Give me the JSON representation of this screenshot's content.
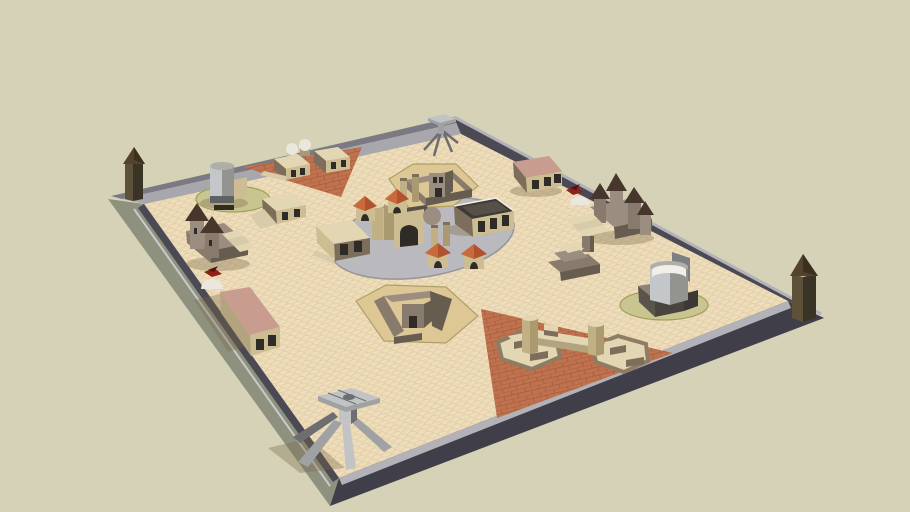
{
  "scene": {
    "type": "3d-model-render",
    "objects": [
      "boundary-wall",
      "corner-tower-west",
      "corner-tower-east",
      "gate-tripod-north",
      "gate-tripod-south",
      "water-silo-west",
      "market-cluster-northwest",
      "ramp-building-north",
      "castle-west",
      "dome-and-bird-west",
      "long-building-southwest",
      "walled-compound-north",
      "central-plaza",
      "plaza-pavilions",
      "grain-silo-gate",
      "warehouse-building",
      "walled-compound-south",
      "long-building-north",
      "dome-and-bird-north",
      "castle-east",
      "stepped-platform-east",
      "spiral-tower-complex-east",
      "bridge-compound-southeast",
      "terracotta-zone-northwest",
      "terracotta-zone-southeast",
      "sand-ground",
      "grass-pad-west",
      "grass-pad-east"
    ]
  },
  "colors": {
    "bg": "#d5d2b8",
    "sand": "#eeddbb",
    "sand_line": "#dfc9a0",
    "wall_nw_dark": "#7b7a83",
    "wall_top": "#a8a7ae",
    "wall_top_light": "#b3b2b9",
    "wall_dark": "#4a4954",
    "wall_darker": "#403f49",
    "wall_outer_sw": "#8f917f",
    "wall_edge_light": "#c9c9cd",
    "plaza": "#bab9be",
    "plaza_edge": "#96959b",
    "terracotta": "#c0724e",
    "terracotta_line": "#a45d3e",
    "pad": "#dcc795",
    "pad_edge": "#b0a066",
    "grass": "#c9c591",
    "grass_edge": "#a19e5c",
    "tan_top": "#e3d6b2",
    "tan_wall": "#cdbd92",
    "tan_mid": "#b3a37f",
    "tan_dark": "#7c6e5a",
    "step_light": "#d8cbaa",
    "hexwall": "#8c7d64",
    "castle_body": "#9b8d7f",
    "castle_mid": "#887a6c",
    "castle_dark": "#675c50",
    "cone": "#46362b",
    "roof_red": "#b0522f",
    "roof_red_light": "#c96a3d",
    "roof_black": "#3e3a35",
    "roof_gray": "#575049",
    "window_dark": "#2f2b26",
    "dome_white": "#eae7de",
    "pink_roof": "#c89c8f",
    "metal_light": "#c2c3c5",
    "metal_mid": "#9fa1a3",
    "metal_dark": "#6d6e70",
    "silo_light": "#c3c7ca",
    "silo_mid": "#93948f",
    "silo_top": "#aeafa9",
    "silo_back": "#7e7f82",
    "silo_band": "#5f6264",
    "grain_light": "#c1b084",
    "grain_dark": "#ab9a70",
    "base_gray": "#8d8377",
    "base_mid": "#5a544c",
    "base_dark": "#4a443e",
    "base_darker": "#3d3836",
    "tower_brown": "#5e5139",
    "tower_brown_dark": "#3a3426",
    "tower_cap": "#52422e",
    "tower_cap_dark": "#3b2f1e",
    "bird_red": "#8e201c",
    "bird_dark": "#541010",
    "trim_white": "#f2efe8",
    "shadow": "rgba(120,104,72,0.35)"
  }
}
